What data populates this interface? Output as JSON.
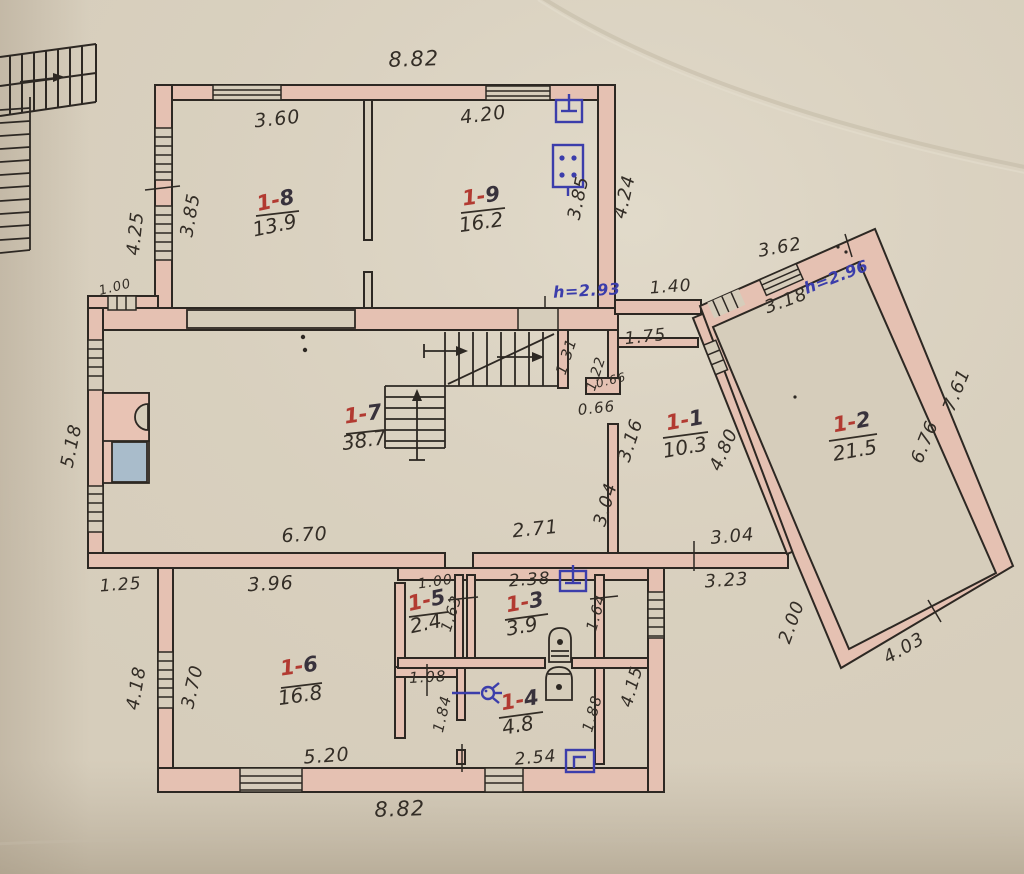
{
  "palette": {
    "paper": "#d6cdbb",
    "paper_light": "#e0d9c9",
    "wall_fill": "#e5c1b2",
    "ink": "#2d2823",
    "red_accent": "#b23a31",
    "blue_accent": "#3b3dab",
    "fixture_blue": "#a9bccb",
    "fixture_pink": "#e8c3b4"
  },
  "rooms": [
    {
      "prefix": "1-",
      "num": "8",
      "area": "13.9",
      "nx": 277,
      "ny": 207,
      "ax": 276,
      "ay": 232,
      "b": [
        256,
        216,
        299,
        211
      ],
      "r": -12
    },
    {
      "prefix": "1-",
      "num": "9",
      "area": "16.2",
      "nx": 482,
      "ny": 203,
      "ax": 482,
      "ay": 229,
      "b": [
        461,
        213,
        505,
        208
      ],
      "r": -8
    },
    {
      "prefix": "1-",
      "num": "2",
      "area": "21.5",
      "nx": 853,
      "ny": 429,
      "ax": 856,
      "ay": 457,
      "b": [
        829,
        441,
        877,
        434
      ],
      "r": -10
    },
    {
      "prefix": "1-",
      "num": "7",
      "area": "38.7",
      "nx": 364,
      "ny": 421,
      "ax": 365,
      "ay": 447,
      "b": [
        346,
        434,
        384,
        430
      ],
      "r": -8
    },
    {
      "prefix": "1-",
      "num": "1",
      "area": "10.3",
      "nx": 686,
      "ny": 427,
      "ax": 686,
      "ay": 454,
      "b": [
        663,
        438,
        708,
        432
      ],
      "r": -10
    },
    {
      "prefix": "1-",
      "num": "6",
      "area": "16.8",
      "nx": 300,
      "ny": 673,
      "ax": 301,
      "ay": 702,
      "b": [
        281,
        688,
        322,
        683
      ],
      "r": -8
    },
    {
      "prefix": "1-",
      "num": "5",
      "area": "2.4",
      "nx": 428,
      "ny": 607,
      "ax": 427,
      "ay": 630,
      "b": [
        409,
        617,
        448,
        612
      ],
      "r": -12
    },
    {
      "prefix": "1-",
      "num": "3",
      "area": "3.9",
      "nx": 526,
      "ny": 609,
      "ax": 523,
      "ay": 633,
      "b": [
        505,
        620,
        548,
        614
      ],
      "r": -10
    },
    {
      "prefix": "1-",
      "num": "4",
      "area": "4.8",
      "nx": 521,
      "ny": 707,
      "ax": 519,
      "ay": 732,
      "b": [
        499,
        718,
        543,
        712
      ],
      "r": -10
    }
  ],
  "dims": [
    {
      "t": "8.82",
      "x": 414,
      "y": 66,
      "r": -2,
      "s": 21
    },
    {
      "t": "3.60",
      "x": 278,
      "y": 125,
      "r": -6,
      "s": 19
    },
    {
      "t": "4.20",
      "x": 484,
      "y": 121,
      "r": -7,
      "s": 19
    },
    {
      "t": "3.85",
      "x": 196,
      "y": 216,
      "r": -80,
      "s": 18
    },
    {
      "t": "3.85",
      "x": 584,
      "y": 199,
      "r": -78,
      "s": 18
    },
    {
      "t": "4.24",
      "x": 630,
      "y": 198,
      "r": -77,
      "s": 18
    },
    {
      "t": "4.25",
      "x": 141,
      "y": 234,
      "r": -84,
      "s": 18
    },
    {
      "t": "1.00",
      "x": 116,
      "y": 291,
      "r": -14,
      "s": 13
    },
    {
      "t": "1.40",
      "x": 671,
      "y": 292,
      "r": -4,
      "s": 17
    },
    {
      "t": "3.62",
      "x": 781,
      "y": 253,
      "r": -10,
      "s": 18
    },
    {
      "t": "3.18",
      "x": 788,
      "y": 306,
      "r": -20,
      "s": 18
    },
    {
      "t": "7.61",
      "x": 962,
      "y": 392,
      "r": -68,
      "s": 18
    },
    {
      "t": "6.76",
      "x": 930,
      "y": 444,
      "r": -68,
      "s": 18
    },
    {
      "t": "4.80",
      "x": 729,
      "y": 452,
      "r": -66,
      "s": 18
    },
    {
      "t": "1.75",
      "x": 646,
      "y": 342,
      "r": -6,
      "s": 17
    },
    {
      "t": "1.31",
      "x": 571,
      "y": 358,
      "r": -72,
      "s": 15
    },
    {
      "t": "1.22",
      "x": 600,
      "y": 375,
      "r": -72,
      "s": 14
    },
    {
      "t": "0.66",
      "x": 612,
      "y": 384,
      "r": -14,
      "s": 12
    },
    {
      "t": "0.66",
      "x": 597,
      "y": 413,
      "r": -6,
      "s": 15
    },
    {
      "t": "3.16",
      "x": 636,
      "y": 442,
      "r": -72,
      "s": 18
    },
    {
      "t": "3.04",
      "x": 611,
      "y": 506,
      "r": -74,
      "s": 18
    },
    {
      "t": "6.70",
      "x": 305,
      "y": 541,
      "r": -3,
      "s": 19
    },
    {
      "t": "2.71",
      "x": 536,
      "y": 535,
      "r": -6,
      "s": 19
    },
    {
      "t": "3.04",
      "x": 733,
      "y": 542,
      "r": -5,
      "s": 18
    },
    {
      "t": "3.23",
      "x": 727,
      "y": 586,
      "r": -4,
      "s": 18
    },
    {
      "t": "2.00",
      "x": 797,
      "y": 624,
      "r": -70,
      "s": 18
    },
    {
      "t": "4.03",
      "x": 907,
      "y": 653,
      "r": -30,
      "s": 18
    },
    {
      "t": "5.18",
      "x": 77,
      "y": 447,
      "r": -78,
      "s": 18
    },
    {
      "t": "1.25",
      "x": 121,
      "y": 590,
      "r": -4,
      "s": 17
    },
    {
      "t": "3.96",
      "x": 271,
      "y": 590,
      "r": -3,
      "s": 19
    },
    {
      "t": "3.70",
      "x": 198,
      "y": 688,
      "r": -77,
      "s": 18
    },
    {
      "t": "4.18",
      "x": 142,
      "y": 689,
      "r": -80,
      "s": 18
    },
    {
      "t": "5.20",
      "x": 327,
      "y": 762,
      "r": -4,
      "s": 19
    },
    {
      "t": "8.82",
      "x": 400,
      "y": 816,
      "r": -2,
      "s": 21
    },
    {
      "t": "1.00",
      "x": 436,
      "y": 586,
      "r": -8,
      "s": 14
    },
    {
      "t": "1.63",
      "x": 456,
      "y": 615,
      "r": -72,
      "s": 15
    },
    {
      "t": "2.38",
      "x": 530,
      "y": 585,
      "r": -4,
      "s": 17
    },
    {
      "t": "1.64",
      "x": 601,
      "y": 614,
      "r": -74,
      "s": 15
    },
    {
      "t": "1.08",
      "x": 428,
      "y": 682,
      "r": -3,
      "s": 15
    },
    {
      "t": "1.84",
      "x": 447,
      "y": 715,
      "r": -77,
      "s": 15
    },
    {
      "t": "1.88",
      "x": 597,
      "y": 715,
      "r": -74,
      "s": 15
    },
    {
      "t": "2.54",
      "x": 536,
      "y": 763,
      "r": -5,
      "s": 17
    },
    {
      "t": "4.15",
      "x": 637,
      "y": 688,
      "r": -74,
      "s": 17
    }
  ],
  "heights": [
    {
      "t": "h=2.93",
      "x": 587,
      "y": 296,
      "r": -3
    },
    {
      "t": "h=2.96",
      "x": 838,
      "y": 282,
      "r": -21
    }
  ],
  "icons": [
    "exterior-stairs-icon",
    "side-stairs-icon",
    "interior-stairs-icon",
    "stove-icon",
    "sink-icon",
    "toilet-icon",
    "boiler-icon",
    "switch-icon",
    "socket-icon",
    "switch-icon",
    "wall-lamp-icon",
    "meter-icon"
  ]
}
